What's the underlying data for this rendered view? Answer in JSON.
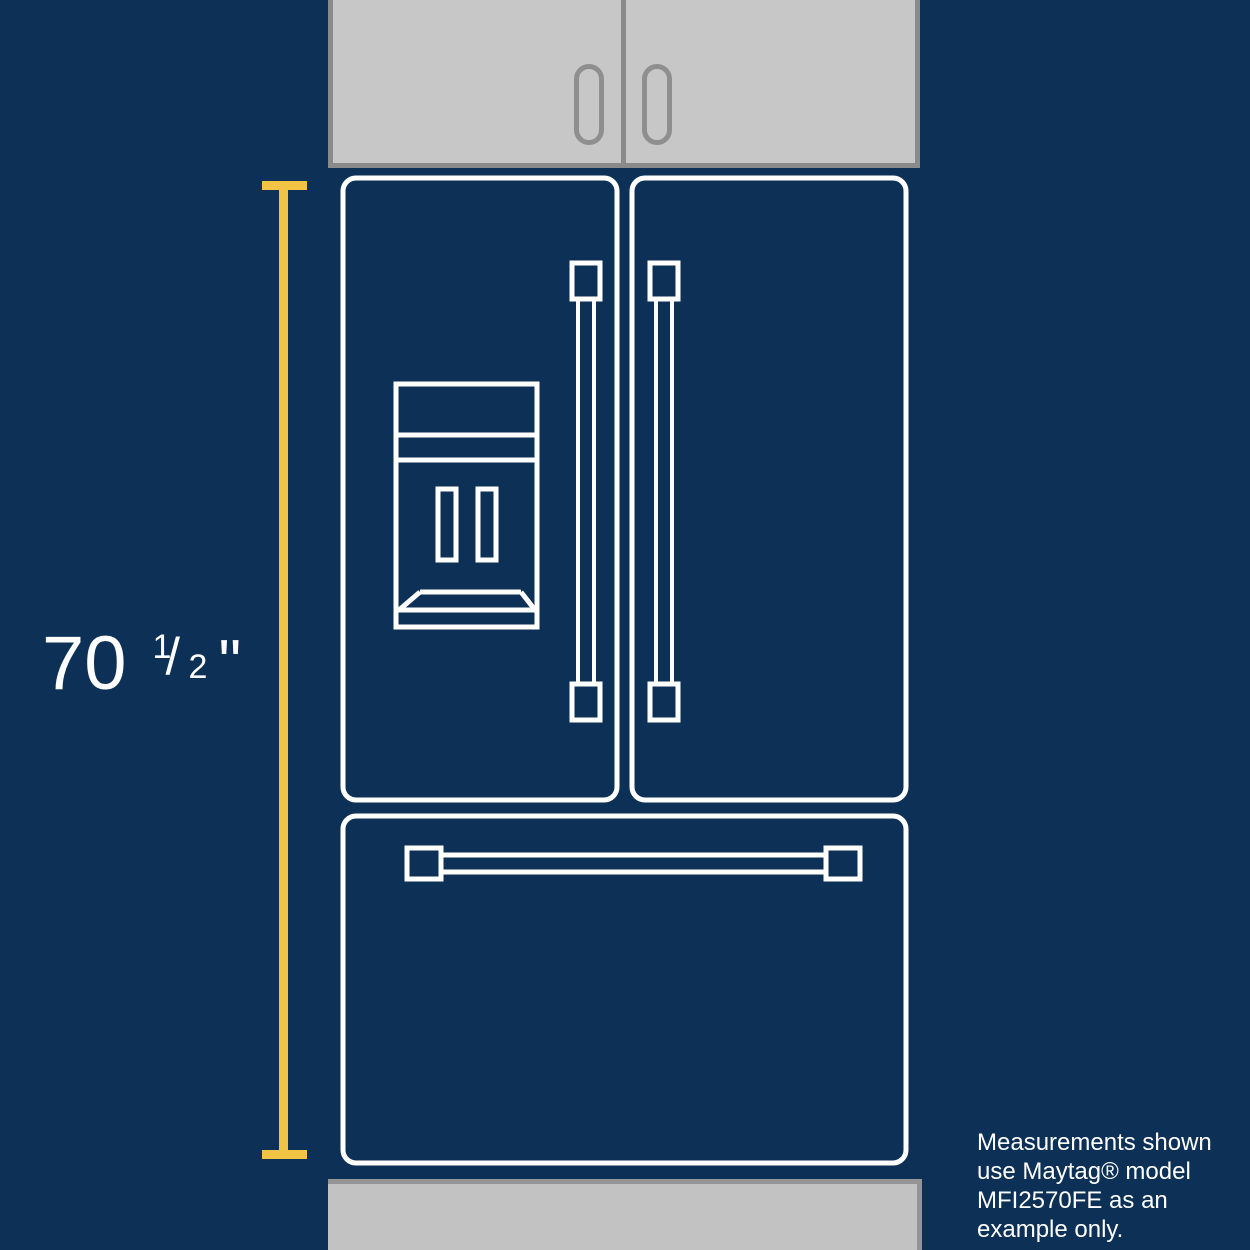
{
  "measurement": {
    "whole": "70",
    "fraction_numerator": "1",
    "fraction_slash": "/",
    "fraction_denominator": "2",
    "unit_mark": "\""
  },
  "disclaimer": {
    "lines": [
      "Measurements shown",
      "use Maytag® model",
      "MFI2570FE as an",
      "example only."
    ]
  },
  "colors": {
    "background_navy": "#0D3056",
    "ruler_yellow": "#F2C443",
    "outline_white": "#FFFFFF",
    "cabinet_fill": "#C7C7C7",
    "cabinet_border": "#8A8A8A",
    "floor_fill": "#C2C2C2",
    "floor_border": "#949494",
    "text_white": "#FFFFFF"
  }
}
